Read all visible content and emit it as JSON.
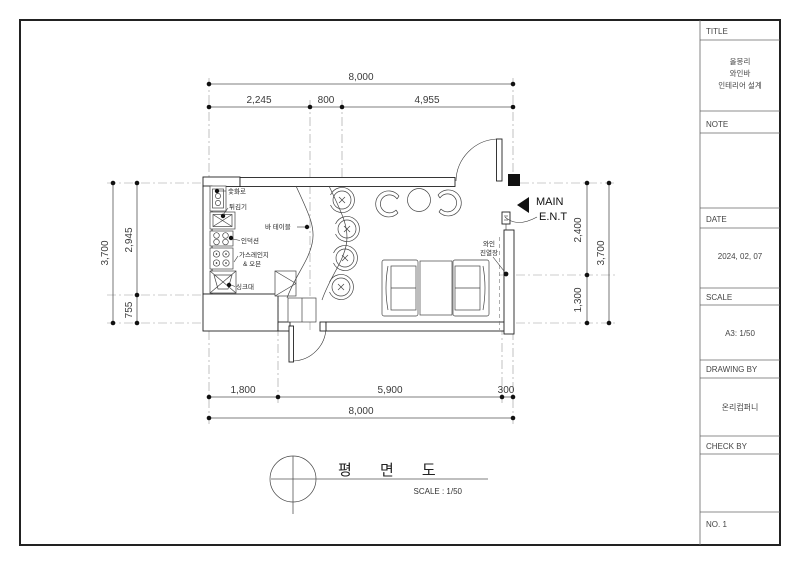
{
  "title_block": {
    "title_label": "TITLE",
    "project_line1": "올몽리",
    "project_line2": "와인바",
    "project_line3": "인테리어 설계",
    "note_label": "NOTE",
    "date_label": "DATE",
    "date_value": "2024, 02, 07",
    "scale_label": "SCALE",
    "scale_value": "A3: 1/50",
    "drawing_by_label": "DRAWING BY",
    "drawing_by_value": "온리컴퍼니",
    "check_by_label": "CHECK BY",
    "sheet_no": "NO. 1"
  },
  "caption": {
    "title": "평 면 도",
    "scale": "SCALE : 1/50"
  },
  "plan": {
    "dims": {
      "top_total": "8,000",
      "top_seg1": "2,245",
      "top_seg2": "800",
      "top_seg3": "4,955",
      "left_total": "3,700",
      "left_seg1": "2,945",
      "left_seg2": "755",
      "right_seg1": "2,400",
      "right_seg2": "1,300",
      "right_total": "3,700",
      "bottom_seg1": "1,800",
      "bottom_seg2": "5,900",
      "bottom_seg3": "300",
      "bottom_total": "8,000"
    },
    "labels": {
      "charcoal_grill": "숯화로",
      "fryer": "튀김기",
      "bar_table": "바 테이블",
      "induction": "인덕션",
      "gas_range_line1": "가스레인지",
      "gas_range_line2": "& 오븐",
      "sink": "싱크대",
      "wine_line1": "와인",
      "wine_line2": "진열장",
      "main_ent_line1": "MAIN",
      "main_ent_line2": "E.N.T"
    }
  }
}
